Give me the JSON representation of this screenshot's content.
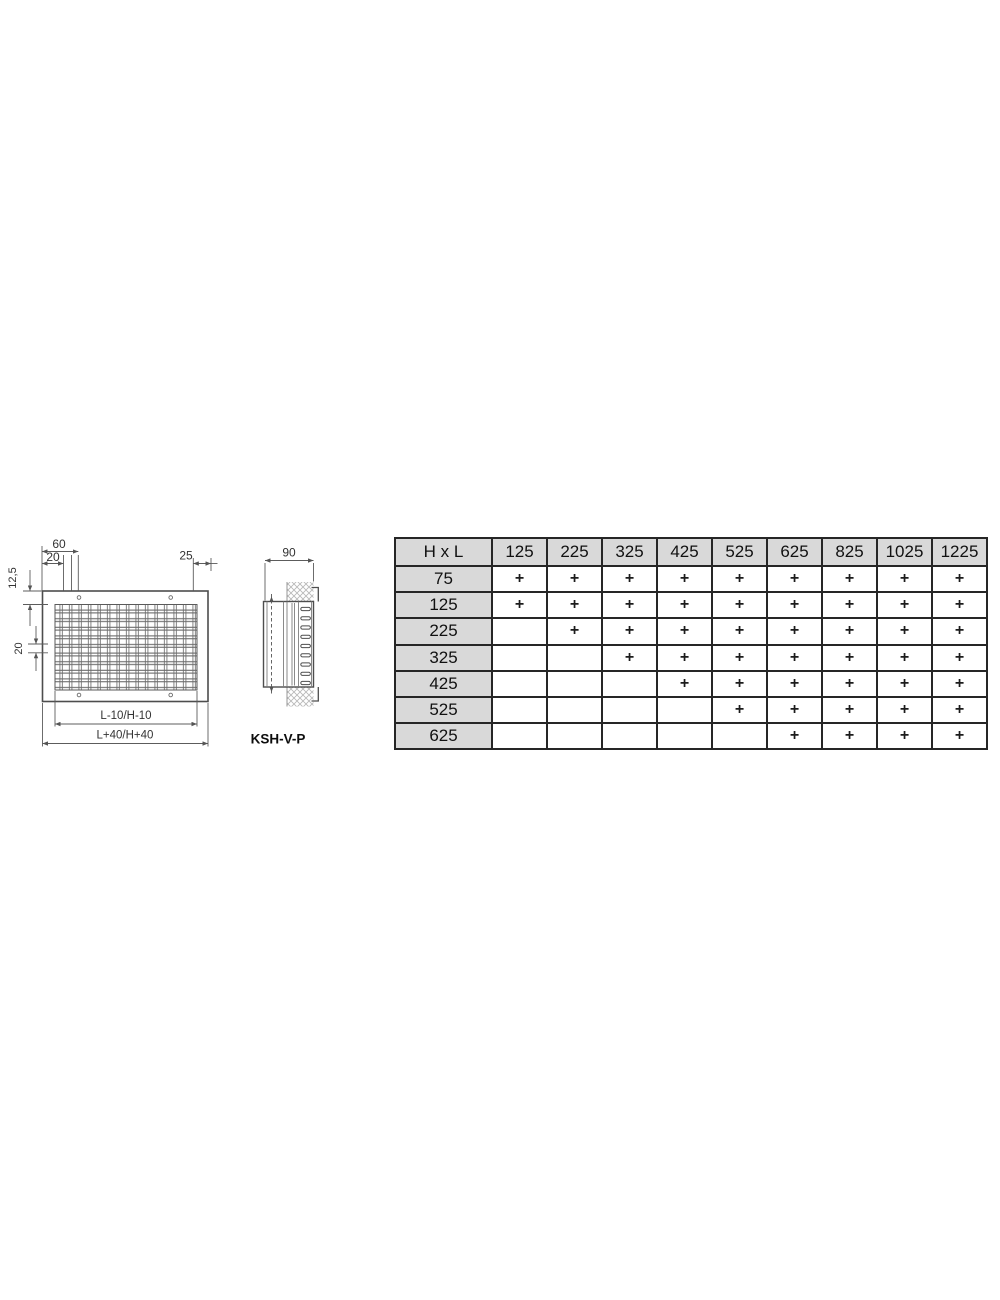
{
  "page": {
    "background": "#ffffff"
  },
  "drawing": {
    "front": {
      "dim_60": "60",
      "dim_20_top": "20",
      "dim_25": "25",
      "dim_12_5": "12,5",
      "dim_20_left": "20",
      "dim_inner": "L-10/H-10",
      "dim_outer": "L+40/H+40"
    },
    "side": {
      "dim_90": "90",
      "model": "KSH-V-P"
    }
  },
  "size_table": {
    "corner_label": "H x L",
    "columns": [
      "125",
      "225",
      "325",
      "425",
      "525",
      "625",
      "825",
      "1025",
      "1225"
    ],
    "rows": [
      {
        "label": "75",
        "cells": [
          "+",
          "+",
          "+",
          "+",
          "+",
          "+",
          "+",
          "+",
          "+"
        ]
      },
      {
        "label": "125",
        "cells": [
          "+",
          "+",
          "+",
          "+",
          "+",
          "+",
          "+",
          "+",
          "+"
        ]
      },
      {
        "label": "225",
        "cells": [
          "",
          "+",
          "+",
          "+",
          "+",
          "+",
          "+",
          "+",
          "+"
        ]
      },
      {
        "label": "325",
        "cells": [
          "",
          "",
          "+",
          "+",
          "+",
          "+",
          "+",
          "+",
          "+"
        ]
      },
      {
        "label": "425",
        "cells": [
          "",
          "",
          "",
          "+",
          "+",
          "+",
          "+",
          "+",
          "+"
        ]
      },
      {
        "label": "525",
        "cells": [
          "",
          "",
          "",
          "",
          "+",
          "+",
          "+",
          "+",
          "+"
        ]
      },
      {
        "label": "625",
        "cells": [
          "",
          "",
          "",
          "",
          "",
          "+",
          "+",
          "+",
          "+"
        ]
      }
    ],
    "header_bg": "#d9d9d9",
    "border_color": "#262626"
  }
}
